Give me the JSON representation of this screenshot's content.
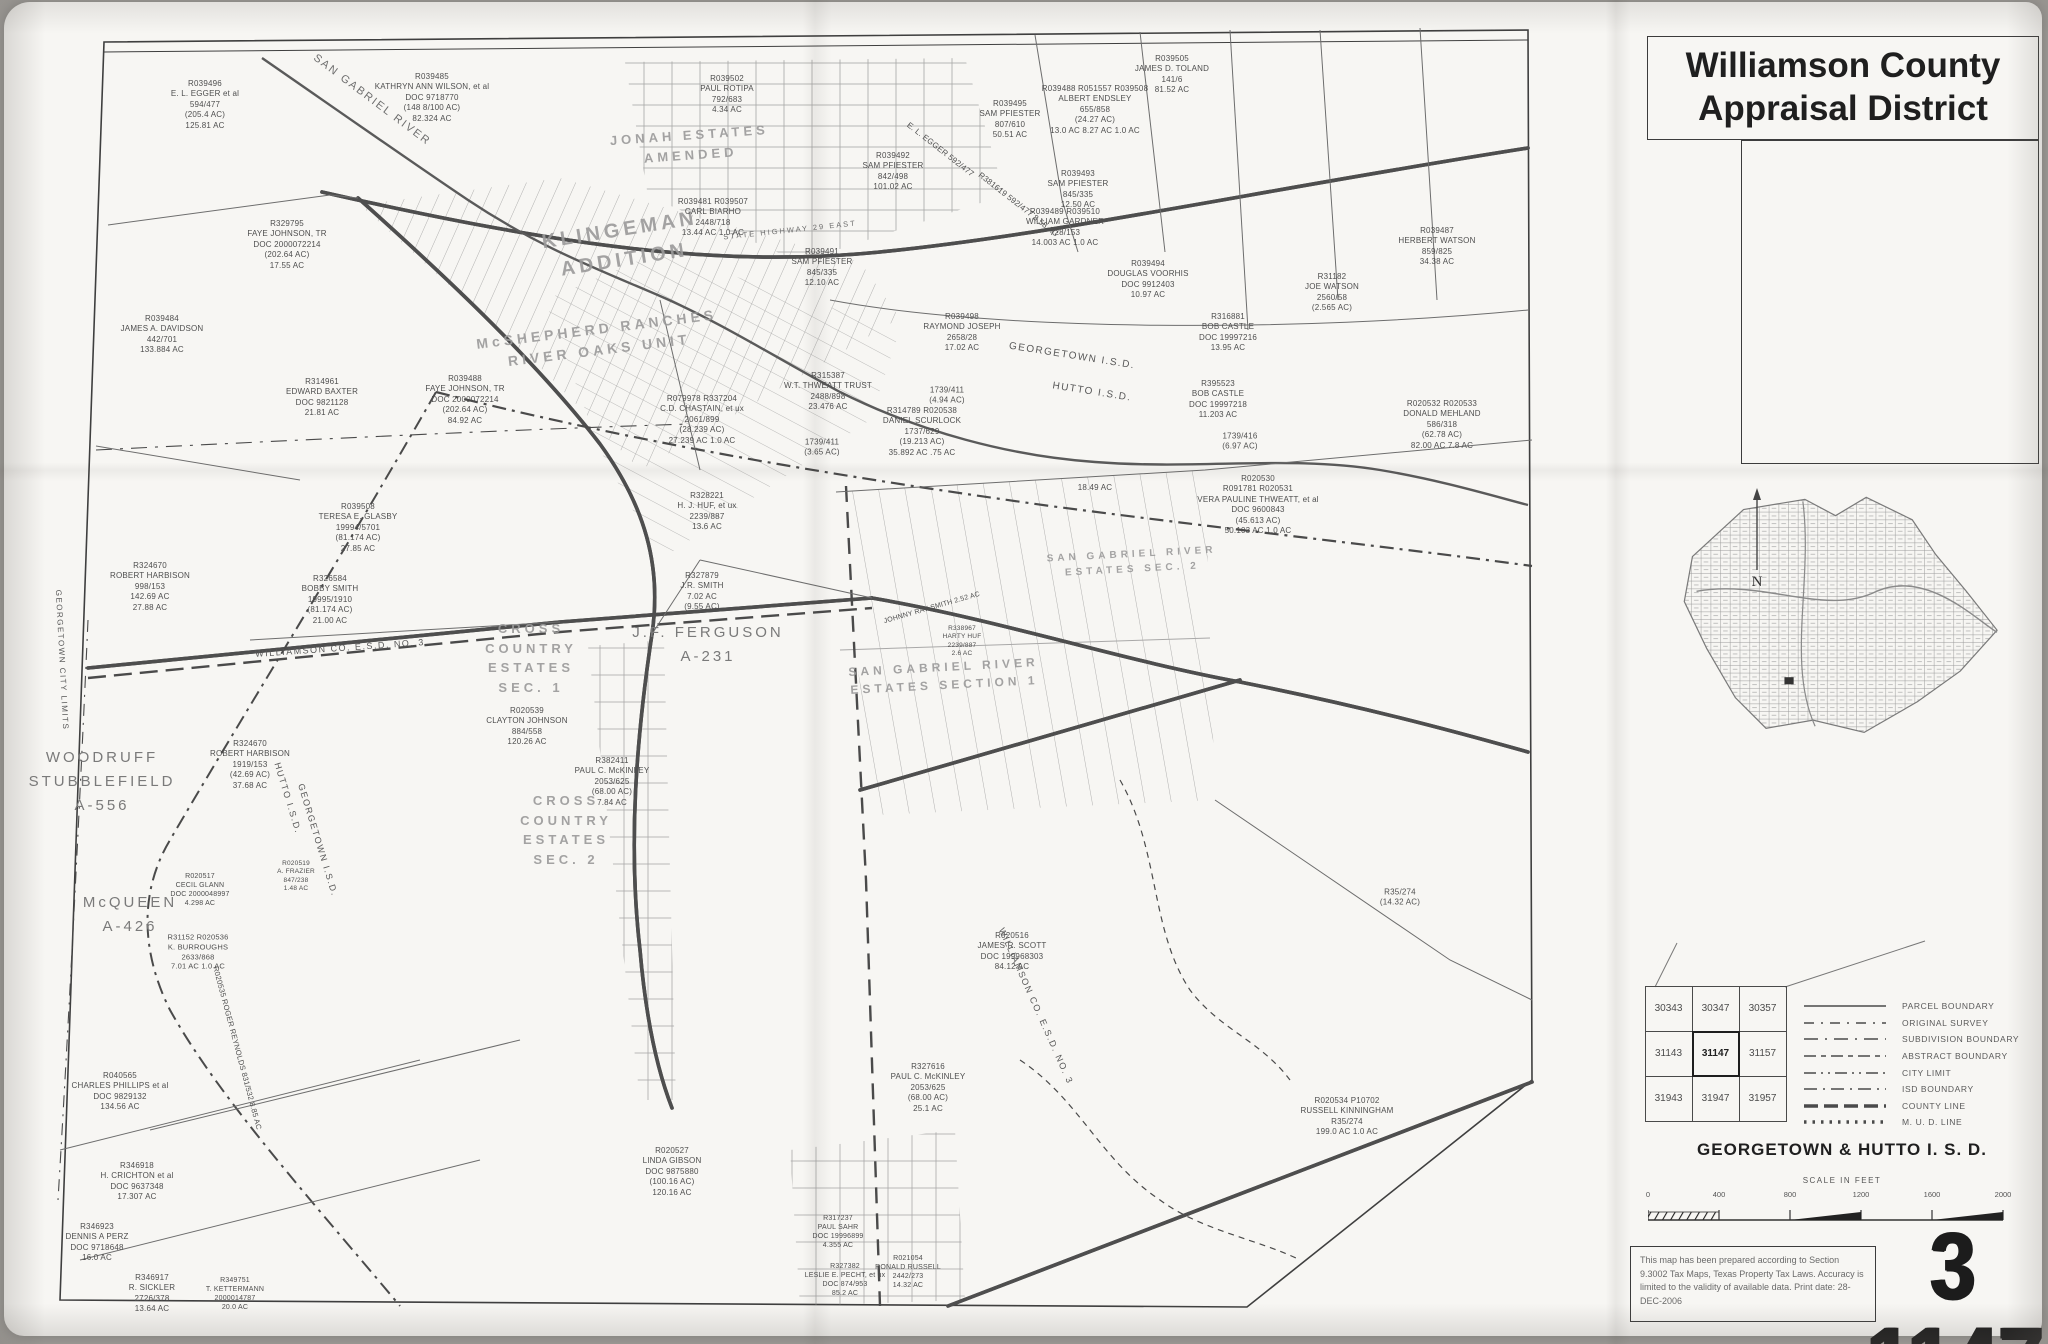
{
  "header": {
    "title_line1": "Williamson County",
    "title_line2": "Appraisal District"
  },
  "map_number": "3 1147",
  "right_panel": {
    "north_label": "N",
    "isd_title": "GEORGETOWN & HUTTO I. S. D.",
    "scale": {
      "title": "SCALE IN FEET",
      "ticks": [
        "0",
        "400",
        "800",
        "1200",
        "1600",
        "2000"
      ]
    },
    "disclaimer": "This map has been prepared according to Section 9.3002 Tax Maps, Texas Property Tax Laws. Accuracy is limited to the validity of available data. Print date: 28-DEC-2006",
    "index_grid": {
      "rows": [
        [
          "30343",
          "30347",
          "30357"
        ],
        [
          "31143",
          "31147",
          "31157"
        ],
        [
          "31943",
          "31947",
          "31957"
        ]
      ],
      "highlight": "31147"
    },
    "legend": {
      "items": [
        {
          "style": "solid",
          "label": "PARCEL BOUNDARY"
        },
        {
          "style": "survey",
          "label": "ORIGINAL SURVEY"
        },
        {
          "style": "subdivision",
          "label": "SUBDIVISION BOUNDARY"
        },
        {
          "style": "abstract",
          "label": "ABSTRACT BOUNDARY"
        },
        {
          "style": "city",
          "label": "CITY LIMIT"
        },
        {
          "style": "isd",
          "label": "ISD BOUNDARY"
        },
        {
          "style": "county",
          "label": "COUNTY LINE"
        },
        {
          "style": "mud",
          "label": "M. U. D. LINE"
        }
      ]
    }
  },
  "map": {
    "area_labels": [
      {
        "x": 622,
        "y": 245,
        "rot": -9,
        "fs": 20,
        "cls": "stencil",
        "lines": [
          "KLINGEMAN",
          "ADDITION"
        ]
      },
      {
        "x": 598,
        "y": 340,
        "rot": -7,
        "fs": 14,
        "cls": "stencil",
        "lines": [
          "McSHEPHERD RANCHES",
          "RIVER OAKS UNIT"
        ]
      },
      {
        "x": 690,
        "y": 145,
        "rot": -4,
        "fs": 13,
        "cls": "stencil",
        "lines": [
          "JONAH ESTATES",
          "AMENDED"
        ]
      },
      {
        "x": 531,
        "y": 658,
        "fs": 13,
        "cls": "stencil",
        "lines": [
          "CROSS",
          "COUNTRY",
          "ESTATES",
          "SEC. 1"
        ]
      },
      {
        "x": 566,
        "y": 830,
        "fs": 13,
        "cls": "stencil",
        "lines": [
          "CROSS",
          "COUNTRY",
          "ESTATES",
          "SEC. 2"
        ]
      },
      {
        "x": 944,
        "y": 676,
        "rot": -3,
        "fs": 12,
        "cls": "stencil",
        "lines": [
          "SAN GABRIEL RIVER",
          "ESTATES SECTION 1"
        ]
      },
      {
        "x": 1132,
        "y": 562,
        "rot": -3,
        "fs": 10,
        "cls": "stencil",
        "lines": [
          "SAN GABRIEL RIVER",
          "ESTATES SEC. 2"
        ]
      },
      {
        "x": 708,
        "y": 645,
        "fs": 15,
        "cls": "abstract",
        "lines": [
          "J.F. FERGUSON",
          "A-231"
        ]
      },
      {
        "x": 102,
        "y": 782,
        "fs": 15,
        "cls": "abstract",
        "lines": [
          "WOODRUFF",
          "STUBBLEFIELD",
          "A-556"
        ]
      },
      {
        "x": 130,
        "y": 915,
        "fs": 15,
        "cls": "abstract",
        "lines": [
          "McQUEEN",
          "A-426"
        ]
      },
      {
        "x": 372,
        "y": 100,
        "rot": 37,
        "fs": 11,
        "cls": "road-lbl",
        "lines": [
          "SAN GABRIEL RIVER"
        ]
      },
      {
        "x": 790,
        "y": 230,
        "rot": -6,
        "fs": 7.5,
        "cls": "road-lbl",
        "lines": [
          "STATE HIGHWAY 29 EAST"
        ]
      },
      {
        "x": 1072,
        "y": 356,
        "rot": 9,
        "fs": 10,
        "cls": "isd",
        "lines": [
          "GEORGETOWN I.S.D."
        ]
      },
      {
        "x": 1092,
        "y": 392,
        "rot": 9,
        "fs": 10,
        "cls": "isd",
        "lines": [
          "HUTTO I.S.D."
        ]
      },
      {
        "x": 318,
        "y": 840,
        "rot": 73,
        "fs": 9,
        "cls": "isd",
        "lines": [
          "GEORGETOWN I.S.D."
        ]
      },
      {
        "x": 288,
        "y": 798,
        "rot": 73,
        "fs": 9,
        "cls": "isd",
        "lines": [
          "HUTTO I.S.D."
        ]
      },
      {
        "x": 340,
        "y": 648,
        "rot": -4,
        "fs": 9,
        "cls": "isd",
        "lines": [
          "WILLIAMSON CO. E.S.D. NO. 3"
        ]
      },
      {
        "x": 1036,
        "y": 1006,
        "rot": 66,
        "fs": 9,
        "cls": "isd",
        "lines": [
          "WILLIAMSON CO. E.S.D. NO. 3"
        ]
      },
      {
        "x": 62,
        "y": 660,
        "rot": 87,
        "fs": 8,
        "cls": "isd",
        "lines": [
          "GEORGETOWN CITY LIMITS"
        ]
      }
    ],
    "parcels": [
      {
        "x": 205,
        "y": 105,
        "lines": [
          "R039496",
          "E. L. EGGER et al",
          "594/477",
          "(205.4 AC)",
          "125.81 AC"
        ]
      },
      {
        "x": 287,
        "y": 245,
        "lines": [
          "R329795",
          "FAYE JOHNSON, TR",
          "DOC 2000072214",
          "(202.64 AC)",
          "17.55 AC"
        ]
      },
      {
        "x": 162,
        "y": 335,
        "lines": [
          "R039484",
          "JAMES A. DAVIDSON",
          "442/701",
          "133.884 AC"
        ]
      },
      {
        "x": 322,
        "y": 398,
        "lines": [
          "R314961",
          "EDWARD BAXTER",
          "DOC 9821128",
          "21.81 AC"
        ]
      },
      {
        "x": 465,
        "y": 400,
        "lines": [
          "R039488",
          "FAYE JOHNSON, TR",
          "DOC 2000072214",
          "(202.64 AC)",
          "84.92 AC"
        ]
      },
      {
        "x": 150,
        "y": 587,
        "lines": [
          "R324670",
          "ROBERT HARBISON",
          "998/153",
          "142.69 AC",
          "27.88 AC"
        ]
      },
      {
        "x": 358,
        "y": 528,
        "lines": [
          "R039508",
          "TERESA E. GLASBY",
          "19994/5701",
          "(81.174 AC)",
          "27.85 AC"
        ]
      },
      {
        "x": 330,
        "y": 600,
        "lines": [
          "R326584",
          "BOBBY SMITH",
          "19995/1910",
          "(81.174 AC)",
          "21.00 AC"
        ]
      },
      {
        "x": 432,
        "y": 98,
        "lines": [
          "R039485",
          "KATHRYN ANN WILSON, et al",
          "DOC 9718770",
          "(148 8/100 AC)",
          "82.324 AC"
        ]
      },
      {
        "x": 727,
        "y": 95,
        "lines": [
          "R039502",
          "PAUL ROTIPA",
          "792/683",
          "4.34 AC"
        ]
      },
      {
        "x": 713,
        "y": 218,
        "lines": [
          "R039481 R039507",
          "CARL BIARHO",
          "2448/718",
          "13.44 AC    1.0 AC"
        ]
      },
      {
        "x": 962,
        "y": 333,
        "lines": [
          "R039498",
          "RAYMOND JOSEPH",
          "2658/28",
          "17.02 AC"
        ]
      },
      {
        "x": 1065,
        "y": 228,
        "lines": [
          "R039489 R039510",
          "WILLIAM GARDNER",
          "728/153",
          "14.003 AC  1.0 AC"
        ]
      },
      {
        "x": 893,
        "y": 172,
        "lines": [
          "R039492",
          "SAM PFIESTER",
          "842/498",
          "101.02 AC"
        ]
      },
      {
        "x": 1010,
        "y": 120,
        "lines": [
          "R039495",
          "SAM PFIESTER",
          "807/610",
          "50.51 AC"
        ]
      },
      {
        "x": 1095,
        "y": 110,
        "lines": [
          "R039488  R051557  R039508",
          "ALBERT ENDSLEY",
          "655/858",
          "(24.27 AC)",
          "13.0 AC  8.27 AC  1.0 AC"
        ]
      },
      {
        "x": 1172,
        "y": 75,
        "lines": [
          "R039505",
          "JAMES D. TOLAND",
          "141/6",
          "81.52 AC"
        ]
      },
      {
        "x": 1078,
        "y": 190,
        "lines": [
          "R039493",
          "SAM PFIESTER",
          "845/335",
          "12.50 AC"
        ]
      },
      {
        "x": 1148,
        "y": 280,
        "lines": [
          "R039494",
          "DOUGLAS VOORHIS",
          "DOC 9912403",
          "10.97 AC"
        ]
      },
      {
        "x": 1228,
        "y": 333,
        "lines": [
          "R316881",
          "BOB CASTLE",
          "DOC 19997216",
          "13.95 AC"
        ]
      },
      {
        "x": 1218,
        "y": 400,
        "lines": [
          "R395523",
          "BOB CASTLE",
          "DOC 19997218",
          "11.203 AC"
        ]
      },
      {
        "x": 1332,
        "y": 293,
        "lines": [
          "R31182",
          "JOE WATSON",
          "2560/58",
          "(2.565 AC)"
        ]
      },
      {
        "x": 1437,
        "y": 247,
        "lines": [
          "R039487",
          "HERBERT WATSON",
          "859/825",
          "34.38 AC"
        ]
      },
      {
        "x": 828,
        "y": 392,
        "lines": [
          "R315387",
          "W.T. THWEATT TRUST",
          "2488/898",
          "23.476 AC"
        ]
      },
      {
        "x": 702,
        "y": 420,
        "lines": [
          "R079978 R337204",
          "C.D. CHASTAIN, et ux",
          "2061/899",
          "(28.239 AC)",
          "27.239 AC    1.0 AC"
        ]
      },
      {
        "x": 707,
        "y": 512,
        "lines": [
          "R328221",
          "H. J. HUF, et ux",
          "2239/887",
          "13.6 AC"
        ]
      },
      {
        "x": 702,
        "y": 592,
        "lines": [
          "R327879",
          "J.R. SMITH",
          "7.02 AC",
          "(9.55 AC)"
        ]
      },
      {
        "x": 922,
        "y": 432,
        "lines": [
          "R314789 R020538",
          "DANIEL SCURLOCK",
          "1737/629",
          "(19.213 AC)",
          "35.892 AC      .75 AC"
        ]
      },
      {
        "x": 947,
        "y": 396,
        "lines": [
          "1739/411",
          "(4.94 AC)"
        ]
      },
      {
        "x": 1240,
        "y": 442,
        "lines": [
          "1739/416",
          "(6.97 AC)"
        ]
      },
      {
        "x": 822,
        "y": 448,
        "lines": [
          "1739/411",
          "(3.65 AC)"
        ]
      },
      {
        "x": 1258,
        "y": 505,
        "lines": [
          "R020530",
          "R091781  R020531",
          "VERA PAULINE THWEATT, et al",
          "DOC 9600843",
          "(45.613 AC)",
          "50.103 AC   1.0 AC"
        ]
      },
      {
        "x": 1095,
        "y": 488,
        "lines": [
          "18.49 AC"
        ]
      },
      {
        "x": 1442,
        "y": 425,
        "lines": [
          "R020532 R020533",
          "DONALD MEHLAND",
          "586/318",
          "(62.78 AC)",
          "82.00 AC   7.8 AC"
        ]
      },
      {
        "x": 527,
        "y": 727,
        "lines": [
          "R020539",
          "CLAYTON JOHNSON",
          "884/558",
          "120.26 AC"
        ]
      },
      {
        "x": 672,
        "y": 1172,
        "lines": [
          "R020527",
          "LINDA GIBSON",
          "DOC 9875880",
          "(100.16 AC)",
          "120.16 AC"
        ]
      },
      {
        "x": 1012,
        "y": 952,
        "lines": [
          "R020516",
          "JAMES R. SCOTT",
          "DOC 199968303",
          "84.12 AC"
        ]
      },
      {
        "x": 928,
        "y": 1088,
        "lines": [
          "R327616",
          "PAUL C. McKINLEY",
          "2053/625",
          "(68.00 AC)",
          "25.1 AC"
        ]
      },
      {
        "x": 612,
        "y": 782,
        "lines": [
          "R382411",
          "PAUL C. McKINLEY",
          "2053/625",
          "(68.00 AC)",
          "7.84 AC"
        ]
      },
      {
        "x": 1347,
        "y": 1117,
        "lines": [
          "R020534  P10702",
          "RUSSELL KINNINGHAM",
          "R35/274",
          "199.0 AC  1.0 AC"
        ]
      },
      {
        "x": 1400,
        "y": 898,
        "lines": [
          "R35/274",
          "(14.32 AC)"
        ]
      },
      {
        "x": 120,
        "y": 1092,
        "lines": [
          "R040565",
          "CHARLES PHILLIPS et al",
          "DOC 9829132",
          "134.56 AC"
        ]
      },
      {
        "x": 137,
        "y": 1182,
        "lines": [
          "R346918",
          "H. CRICHTON et al",
          "DOC 9637348",
          "17.307 AC"
        ]
      },
      {
        "x": 97,
        "y": 1243,
        "lines": [
          "R346923",
          "DENNIS A PERZ",
          "DOC 9718648",
          "16.0 AC"
        ]
      },
      {
        "x": 152,
        "y": 1294,
        "lines": [
          "R346917",
          "R. SICKLER",
          "2726/378",
          "13.64 AC"
        ]
      },
      {
        "x": 235,
        "y": 1294,
        "fs": 7,
        "lines": [
          "R349751",
          "T. KETTERMANN",
          "2000014787",
          "20.0 AC"
        ]
      },
      {
        "x": 250,
        "y": 765,
        "lines": [
          "R324670",
          "ROBERT HARBISON",
          "1919/153",
          "(42.69 AC)",
          "37.68 AC"
        ]
      },
      {
        "x": 198,
        "y": 952,
        "fs": 7.5,
        "lines": [
          "R31152  R020536",
          "K. BURROUGHS",
          "2633/868",
          "7.01 AC  1.0 AC"
        ]
      },
      {
        "x": 200,
        "y": 890,
        "fs": 7,
        "lines": [
          "R020517",
          "CECIL GLANN",
          "DOC 2000048997",
          "4.298 AC"
        ]
      },
      {
        "x": 296,
        "y": 877,
        "fs": 6.5,
        "lines": [
          "R020519",
          "A. FRAZIER",
          "847/238",
          "1.48 AC"
        ]
      },
      {
        "x": 845,
        "y": 1280,
        "fs": 7,
        "lines": [
          "R327382",
          "LESLIE E. PECHT, et ux",
          "DOC 874/953",
          "85.2 AC"
        ]
      },
      {
        "x": 838,
        "y": 1232,
        "fs": 7,
        "lines": [
          "R317237",
          "PAUL SAHR",
          "DOC 19996899",
          "4.355 AC"
        ]
      },
      {
        "x": 908,
        "y": 1272,
        "fs": 7,
        "lines": [
          "R021054",
          "RONALD RUSSELL",
          "2442/273",
          "14.32 AC"
        ]
      },
      {
        "x": 962,
        "y": 642,
        "fs": 6.5,
        "lines": [
          "R338967",
          "HARTY HUF",
          "2239/887",
          "2.6 AC"
        ]
      },
      {
        "x": 822,
        "y": 268,
        "lines": [
          "R039491",
          "SAM PFIESTER",
          "845/335",
          "12.10 AC"
        ]
      },
      {
        "x": 940,
        "y": 150,
        "rot": 38,
        "lines": [
          "E. L. EGGER  592/477"
        ]
      },
      {
        "x": 1018,
        "y": 205,
        "rot": 38,
        "lines": [
          "R381619  592/477  8.58 AC"
        ]
      },
      {
        "x": 932,
        "y": 608,
        "rot": -16,
        "fs": 7,
        "lines": [
          "JOHNNY RAY SMITH  2.52 AC"
        ]
      },
      {
        "x": 237,
        "y": 1048,
        "rot": 75,
        "fs": 7.5,
        "lines": [
          "R020535  ROGER REYNOLDS  831/532  8.85 AC"
        ]
      }
    ]
  }
}
